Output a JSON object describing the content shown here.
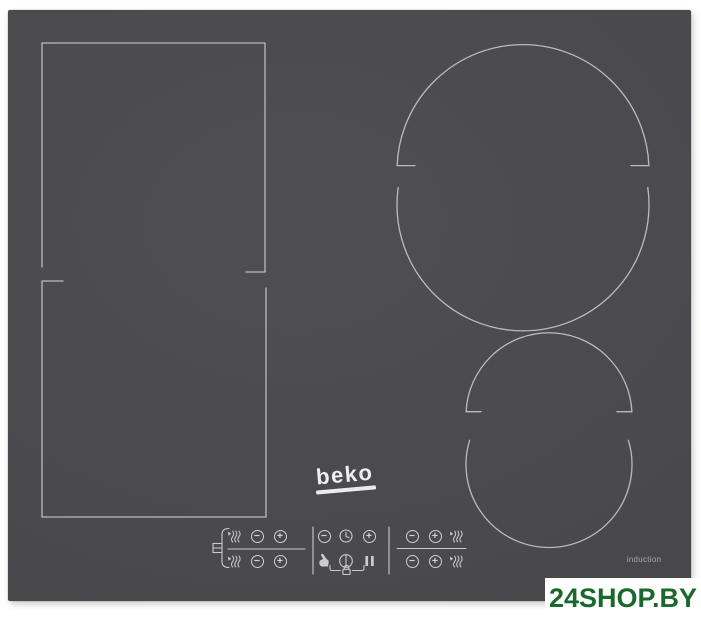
{
  "brand": {
    "logo_text": "beko"
  },
  "hob": {
    "type_label": "induction",
    "surface_color": "#4a4a4d",
    "line_color": "#c3c4c6",
    "zones": [
      "flex-zone-upper-rect",
      "flex-zone-lower-rect",
      "large-round-zone",
      "small-round-zone"
    ]
  },
  "controls": {
    "glyphs": {
      "minus": "−",
      "plus": "+"
    },
    "left_group": {
      "link_icon": "flex-link-icon",
      "rows": [
        [
          "boost-icon",
          "minus",
          "plus"
        ],
        [
          "boost-icon",
          "minus",
          "plus"
        ]
      ]
    },
    "center_group": {
      "row1": [
        "minus",
        "timer-icon",
        "plus"
      ],
      "row2": [
        "hand-icon",
        "power-icon",
        "pause-icon"
      ],
      "lock_icon": "key-lock-icon"
    },
    "right_group": {
      "rows": [
        [
          "minus",
          "plus",
          "boost-icon"
        ],
        [
          "minus",
          "plus",
          "boost-icon"
        ]
      ]
    }
  },
  "watermark": {
    "text": "24SHOP.BY",
    "text_color": "#1a692c",
    "background_color": "#ffffff"
  }
}
